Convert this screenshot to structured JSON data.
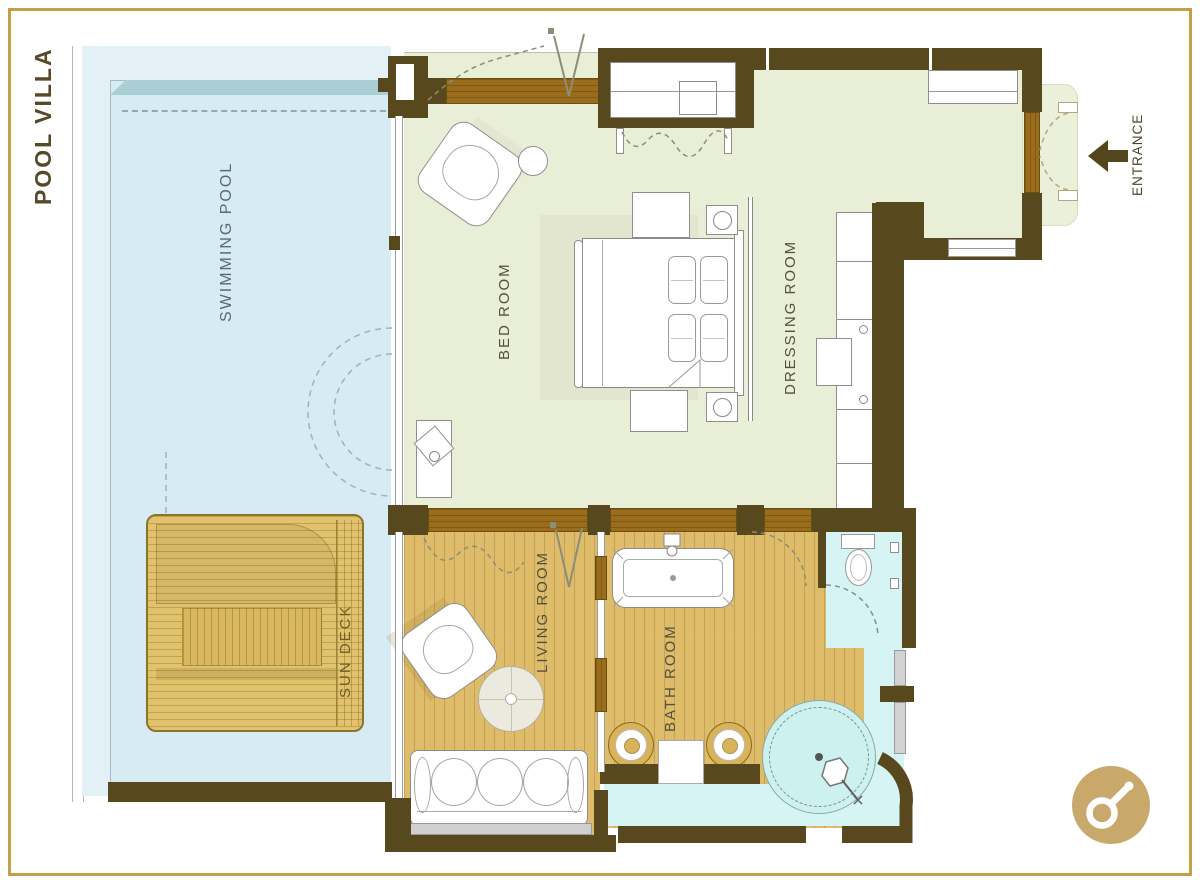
{
  "title": "POOL VILLA",
  "labels": {
    "swimming_pool": "SWIMMING POOL",
    "sun_deck": "SUN DECK",
    "bed_room": "BED ROOM",
    "dressing_room": "DRESSING ROOM",
    "living_room": "LIVING ROOM",
    "bath_room": "BATH ROOM",
    "entrance": "ENTRANCE"
  },
  "colors": {
    "frame_gold": "#c5a04a",
    "wall_brown": "#57491d",
    "wood_door": "#9a6d1d",
    "room_green": "#e9eed7",
    "pool_blue": "#d7ebf4",
    "pool_edge_teal": "#a9ced3",
    "wood_floor": "#dfbc69",
    "deck_wood": "#e2c36d",
    "tile_cyan": "#d6f4f3",
    "logo_gold": "#c9a96b"
  }
}
